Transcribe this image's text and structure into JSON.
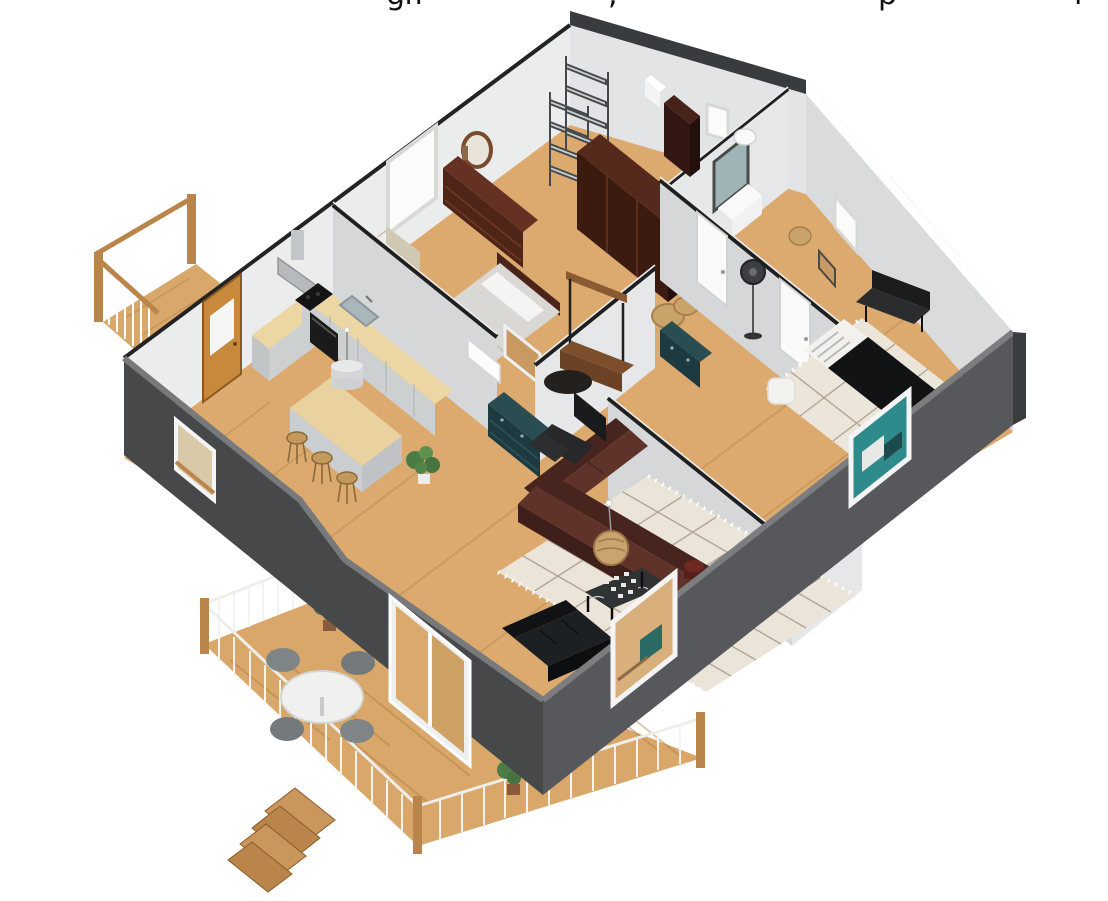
{
  "caption": {
    "fragments": [
      {
        "glyph": "g",
        "x": 386
      },
      {
        "glyph": "ff",
        "x": 404
      },
      {
        "glyph": ",",
        "x": 608
      },
      {
        "glyph": "p",
        "x": 878
      },
      {
        "glyph": "l",
        "x": 1074
      }
    ]
  },
  "scene": {
    "type": "3d-floor-plan-render",
    "view": "isometric-cutaway",
    "rooms": [
      {
        "name": "bedroom-1",
        "furniture": [
          "dresser",
          "round-mirror",
          "window",
          "armchair",
          "bed",
          "wardrobe",
          "closet-shelving"
        ]
      },
      {
        "name": "bathroom",
        "furniture": [
          "vanity-mirror",
          "sink",
          "toilet",
          "laundry-basket",
          "tall-cabinet",
          "window"
        ]
      },
      {
        "name": "bedroom-2",
        "furniture": [
          "standing-fan",
          "black-bed",
          "bench",
          "pouf",
          "diamond-rug",
          "teal-dresser",
          "wall-art",
          "window"
        ]
      },
      {
        "name": "kitchen",
        "furniture": [
          "l-shaped-counter",
          "cooktop",
          "range-hood",
          "oven",
          "sink",
          "island",
          "bar-stools",
          "pendant-lamp",
          "potted-plant",
          "amber-door"
        ]
      },
      {
        "name": "entry-hall",
        "furniture": [
          "coat-rack",
          "storage-bench",
          "round-rug",
          "teal-dresser",
          "corkboard-frame",
          "white-doors"
        ]
      },
      {
        "name": "living-room",
        "furniture": [
          "sectional-sofa",
          "chessboard-coffee-table",
          "woven-pendant-lamp",
          "black-sofa",
          "armchair",
          "ottoman",
          "teal-dresser",
          "diamond-rug",
          "drum-side-table"
        ]
      },
      {
        "name": "balcony",
        "furniture": [
          "railing"
        ]
      },
      {
        "name": "deck",
        "furniture": [
          "round-dining-table",
          "dining-chairs",
          "stairs",
          "railing",
          "potted-plants",
          "sliding-glass-door"
        ]
      }
    ],
    "palette": {
      "exterior_wall": "#47484a",
      "exterior_wall_light": "#57585c",
      "interior_wall": "#e8e9ea",
      "interior_wall_shaded": "#d6d7d9",
      "floor_wood": "#dcaa6e",
      "deck_wood": "#d9a76a",
      "accent_door": "#c8893c",
      "rug": "#ece6da",
      "sofa_brown": "#5f322a",
      "teal_furniture": "#1c3a3f",
      "black_furniture": "#17191b",
      "railing_white": "#f2f2f0",
      "post_wood": "#b9854a"
    }
  }
}
